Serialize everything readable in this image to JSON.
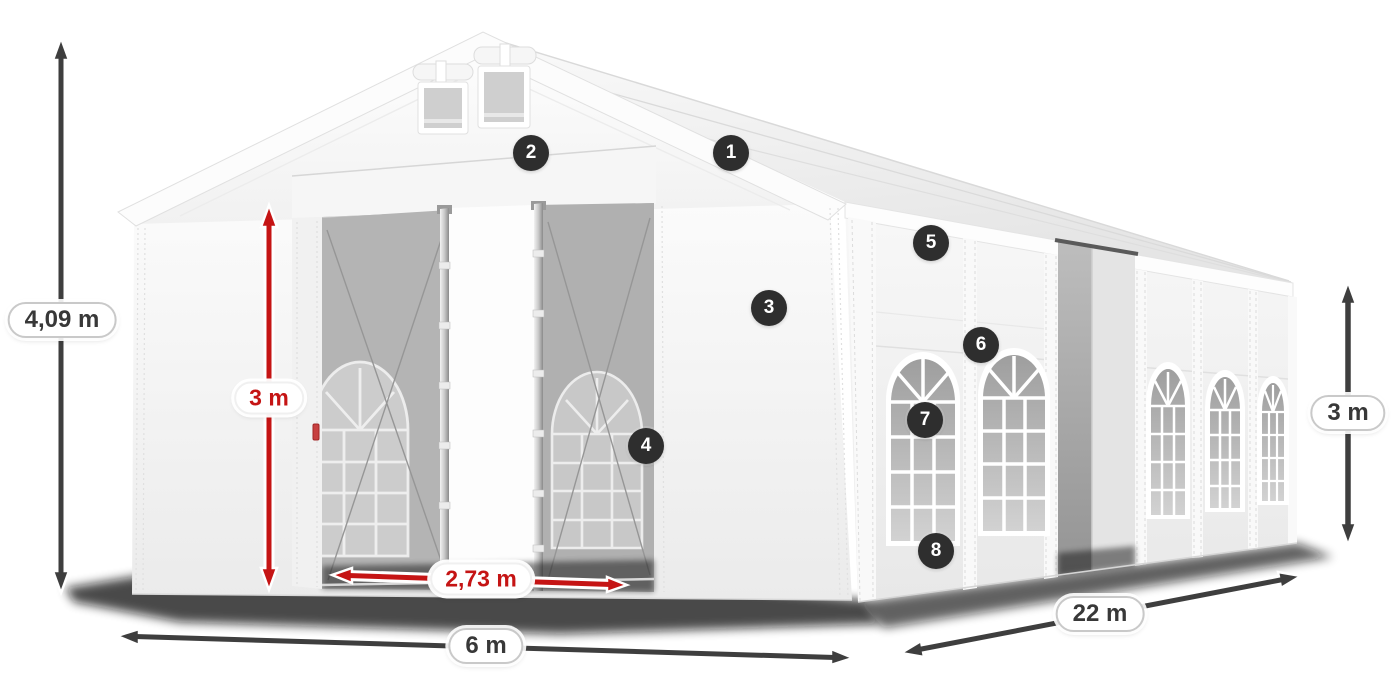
{
  "diagram": {
    "subject": "party-tent-dimension-diagram",
    "dimensions": {
      "total_height": "4,09 m",
      "entrance_height": "3 m",
      "entrance_width": "2,73 m",
      "front_width": "6 m",
      "side_length": "22 m",
      "side_height": "3 m"
    },
    "callouts": [
      {
        "number": "1"
      },
      {
        "number": "2"
      },
      {
        "number": "3"
      },
      {
        "number": "4"
      },
      {
        "number": "5"
      },
      {
        "number": "6"
      },
      {
        "number": "7"
      },
      {
        "number": "8"
      }
    ],
    "colors": {
      "dimension_arrow_dark": "#3e3e3e",
      "dimension_accent_red": "#c51414",
      "badge_background": "#2e2e2e",
      "badge_text": "#ffffff",
      "tent_fabric": "#f4f4f4",
      "interior_mesh": "#b4b4b4"
    }
  }
}
